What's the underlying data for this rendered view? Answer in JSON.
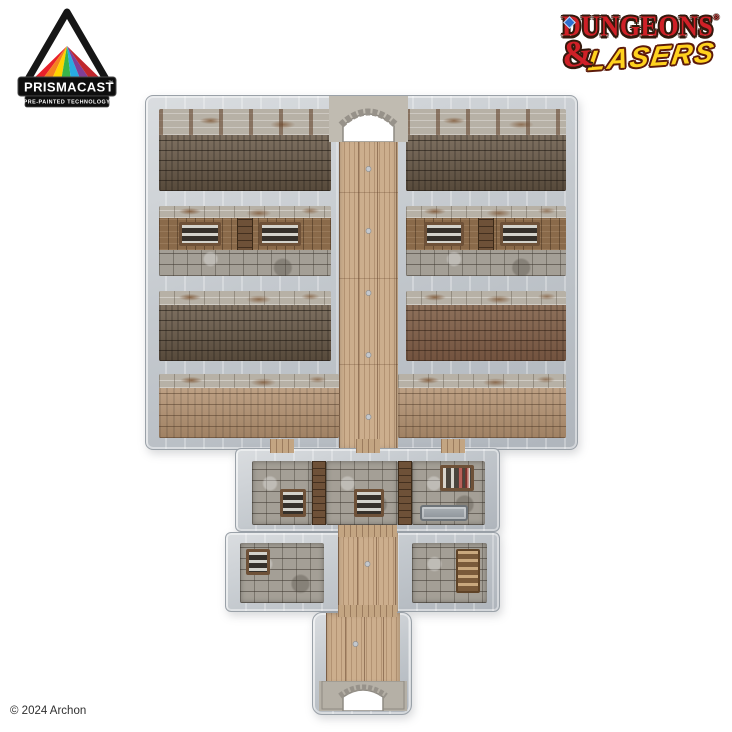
{
  "branding": {
    "prismacast": {
      "name": "PRISMACAST",
      "trademark": "™",
      "tagline": "PRE-PAINTED TECHNOLOGY",
      "rainbow_colors": [
        "#e8212b",
        "#f58220",
        "#ffd400",
        "#3ab54a",
        "#29abe2",
        "#7f3f98",
        "#c1272d"
      ],
      "banner_color": "#0e0e0e",
      "text_color": "#ffffff"
    },
    "dungeons_lasers": {
      "line1": "DUNGEONS",
      "registered": "®",
      "ampersand": "&",
      "line2": "LASERS",
      "red": "#cf2027",
      "yellow": "#ffd21e"
    }
  },
  "footer": {
    "copyright": "© 2024 Archon"
  },
  "terrain_palette": {
    "wall_stone": "#c6cacf",
    "wood_corridor": "#ccae8d",
    "wood_room_dark": "#695947",
    "wood_room_mid": "#b2906f",
    "stone_cell_floor": "#a49f96",
    "wood_frame": "#8a6a4a",
    "background": "#ffffff"
  }
}
